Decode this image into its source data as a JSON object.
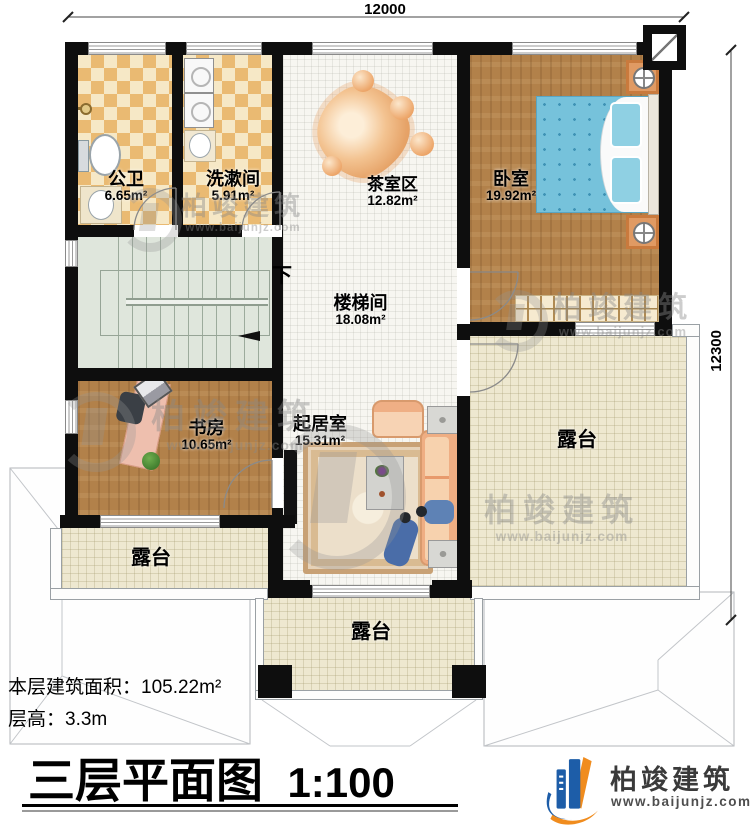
{
  "dimensions": {
    "top": "12000",
    "right": "12300"
  },
  "plan": {
    "rooms": [
      {
        "id": "gongwei",
        "name": "公卫",
        "area": "6.65m²"
      },
      {
        "id": "xishujian",
        "name": "洗漱间",
        "area": "5.91m²"
      },
      {
        "id": "chashiqu",
        "name": "茶室区",
        "area": "12.82m²"
      },
      {
        "id": "woshi",
        "name": "卧室",
        "area": "19.92m²"
      },
      {
        "id": "loutijian",
        "name": "楼梯间",
        "area": "18.08m²"
      },
      {
        "id": "shufang",
        "name": "书房",
        "area": "10.65m²"
      },
      {
        "id": "qijushi",
        "name": "起居室",
        "area": "15.31m²"
      }
    ],
    "terraces": [
      {
        "name": "露台"
      },
      {
        "name": "露台"
      },
      {
        "name": "露台"
      }
    ],
    "stairs_direction": "下"
  },
  "footer": {
    "building_area_label": "本层建筑面积：",
    "building_area_value": "105.22m²",
    "floor_height_label": "层高：",
    "floor_height_value": "3.3m",
    "title": "三层平面图",
    "scale": "1:100"
  },
  "brand": {
    "name": "柏竣建筑",
    "website": "www.baijunjz.com"
  },
  "watermark": {
    "name": "柏竣建筑",
    "website": "www.baijunjz.com"
  },
  "colors": {
    "wall": "#0e0e0e",
    "wood_floor": "#b2814a",
    "checker_tile": "#eaba72",
    "terrace_tile": "#eee8d0",
    "stair": "#dfe6dc",
    "bed_blue": "#76c2db",
    "furniture_peach": "#f3b98f",
    "stone_orange": "#e89a5e",
    "logo_blue": "#1d5da8",
    "logo_orange": "#f08c1e"
  }
}
